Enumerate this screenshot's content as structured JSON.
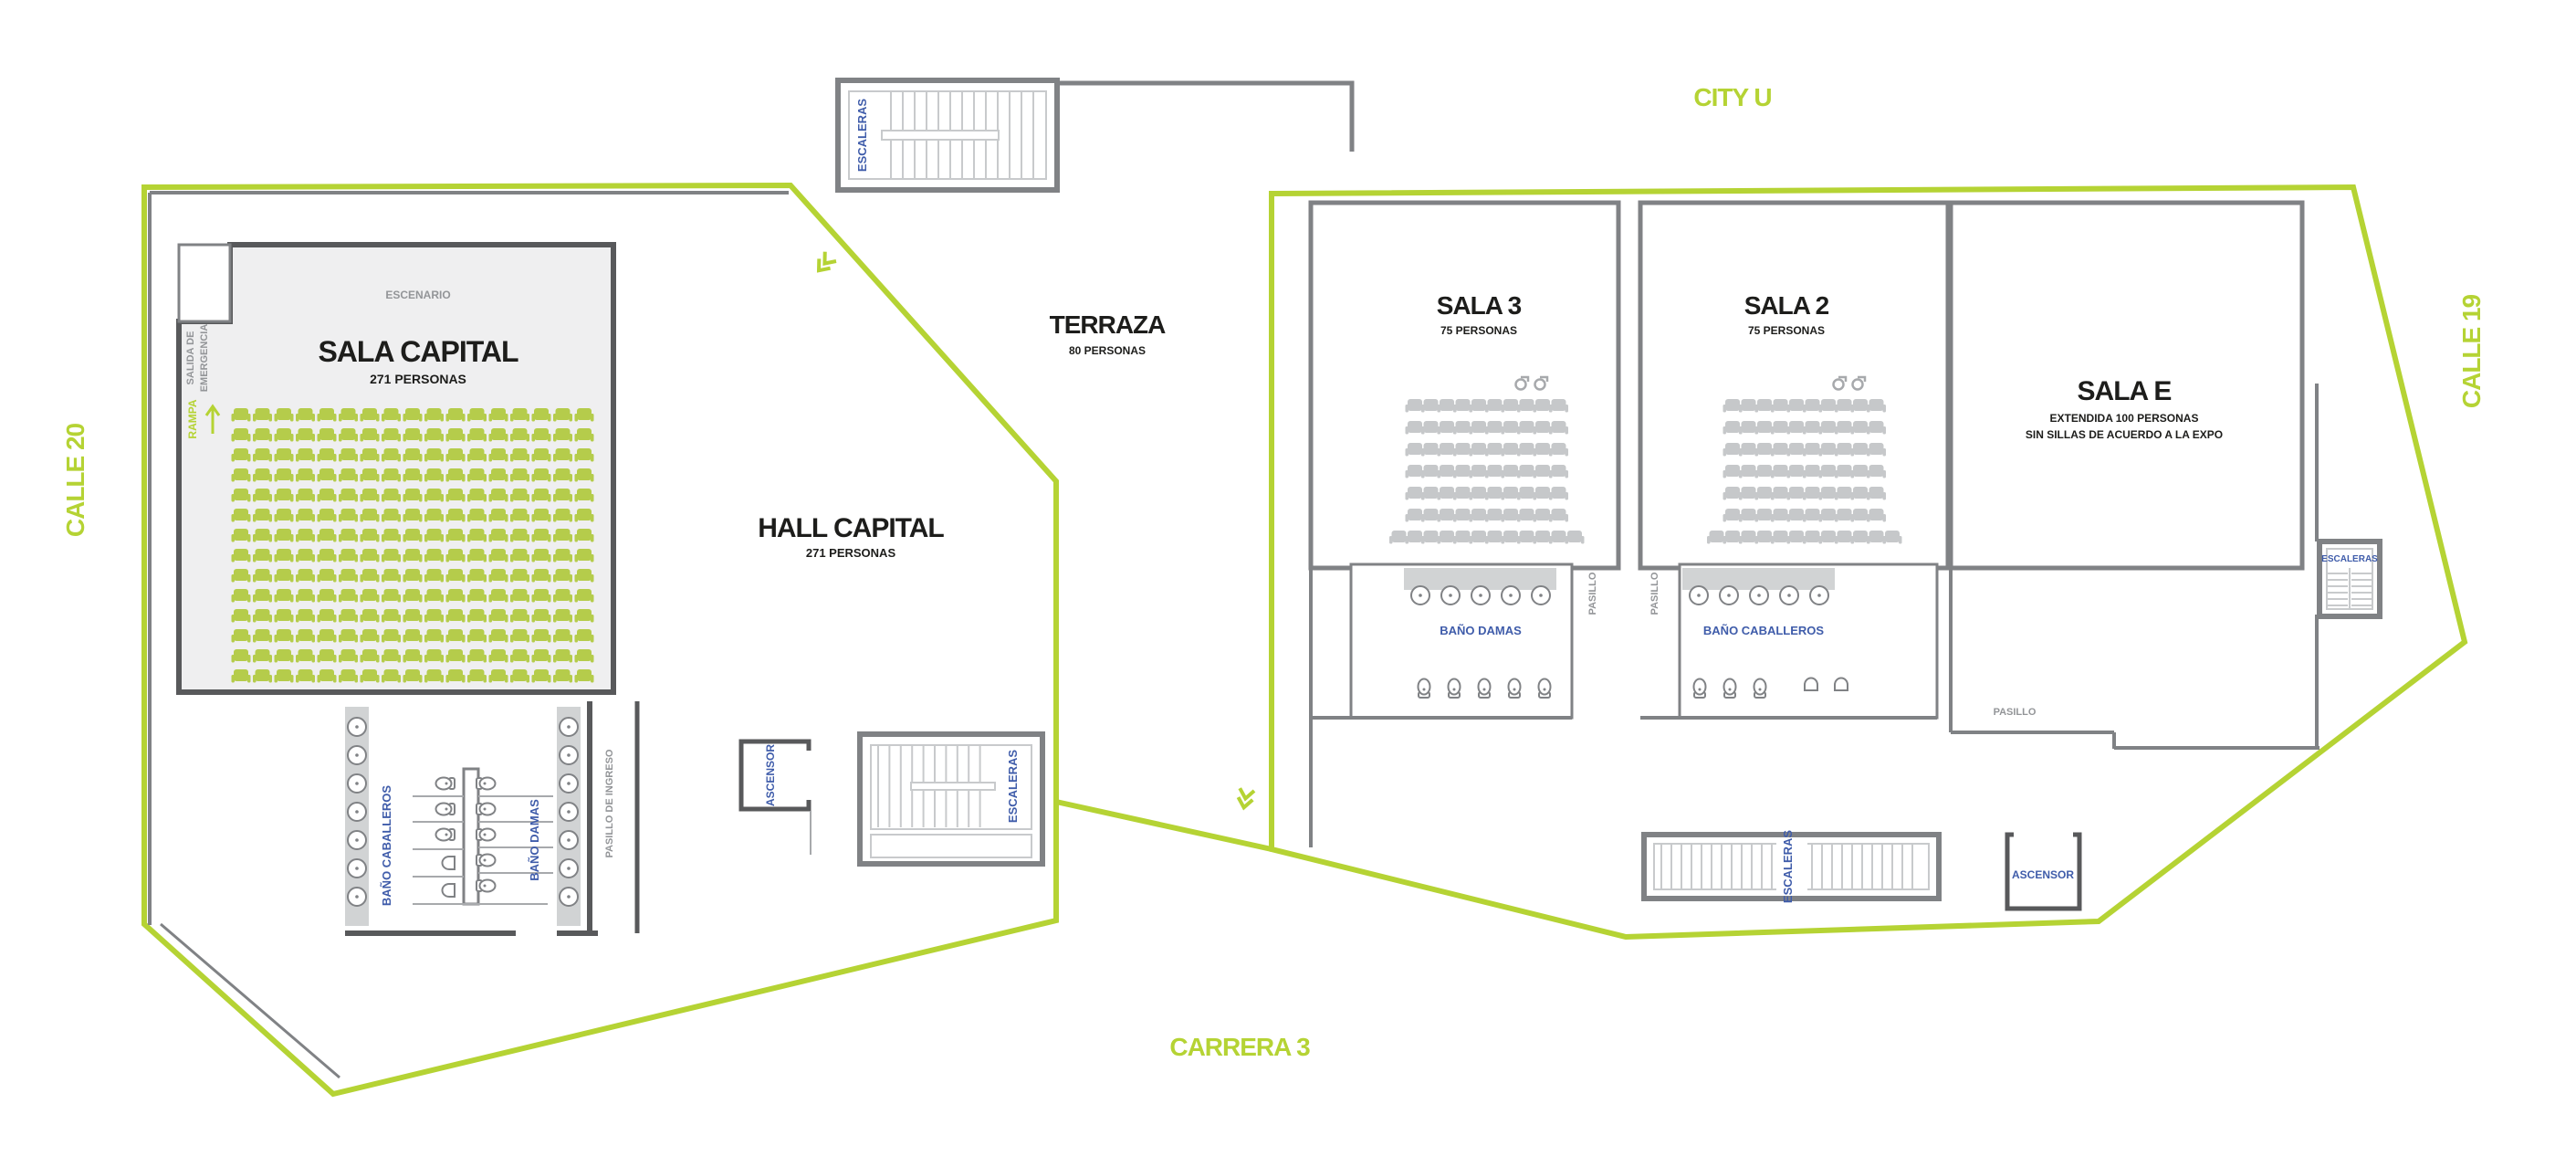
{
  "title": "Floor plan - Capital / City U event venue",
  "colors": {
    "boundary_green": "#b5d334",
    "seat_green": "#b5cc4b",
    "seat_gray": "#c6c8ca",
    "wall_dark": "#58595b",
    "wall": "#808285",
    "tread_light": "#c8cacc",
    "counter_gray": "#d1d3d4",
    "room_fill": "#efeff0",
    "label_blue": "#3f5caa",
    "label_gray": "#939598",
    "label_black": "#1d1d1b"
  },
  "streets": {
    "calle20": "CALLE 20",
    "city_u": "CITY U",
    "calle19": "CALLE 19",
    "carrera3": "CARRERA 3"
  },
  "rooms": {
    "sala_capital": {
      "name": "SALA CAPITAL",
      "capacity": "271 PERSONAS"
    },
    "hall_capital": {
      "name": "HALL CAPITAL",
      "capacity": "271 PERSONAS"
    },
    "terraza": {
      "name": "TERRAZA",
      "capacity": "80 PERSONAS"
    },
    "sala3": {
      "name": "SALA 3",
      "capacity": "75 PERSONAS"
    },
    "sala2": {
      "name": "SALA 2",
      "capacity": "75 PERSONAS"
    },
    "sala_e": {
      "name": "SALA E",
      "capacity_line1": "EXTENDIDA 100 PERSONAS",
      "capacity_line2": "SIN SILLAS DE ACUERDO A LA EXPO"
    },
    "escenario": "ESCENARIO"
  },
  "facilities": {
    "stairs": "ESCALERAS",
    "elevator": "ASCENSOR",
    "bath_women": "BAÑO DAMAS",
    "bath_men": "BAÑO CABALLEROS",
    "hallway": "PASILLO",
    "entry_hall": "PASILLO DE INGRESO",
    "emergency_exit_line1": "SALIDA DE",
    "emergency_exit_line2": "EMERGENCIA",
    "ramp": "RAMPA"
  },
  "seating": {
    "sala_capital": {
      "rows": 14,
      "cols": 17,
      "color": "green"
    },
    "sala3": {
      "rows": 6,
      "cols": 10,
      "last_row_cols": 12,
      "color": "gray"
    },
    "sala2": {
      "rows": 6,
      "cols": 10,
      "last_row_cols": 12,
      "color": "gray"
    }
  },
  "fixtures": {
    "capital_bath": {
      "sinks_per_side": 7,
      "men_toilets": 3,
      "men_urinals": 2,
      "women_toilets": 5
    },
    "damas_bath": {
      "sinks": 5,
      "toilets": 5
    },
    "caballeros_bath": {
      "sinks": 5,
      "toilets": 3,
      "urinals": 2
    }
  }
}
